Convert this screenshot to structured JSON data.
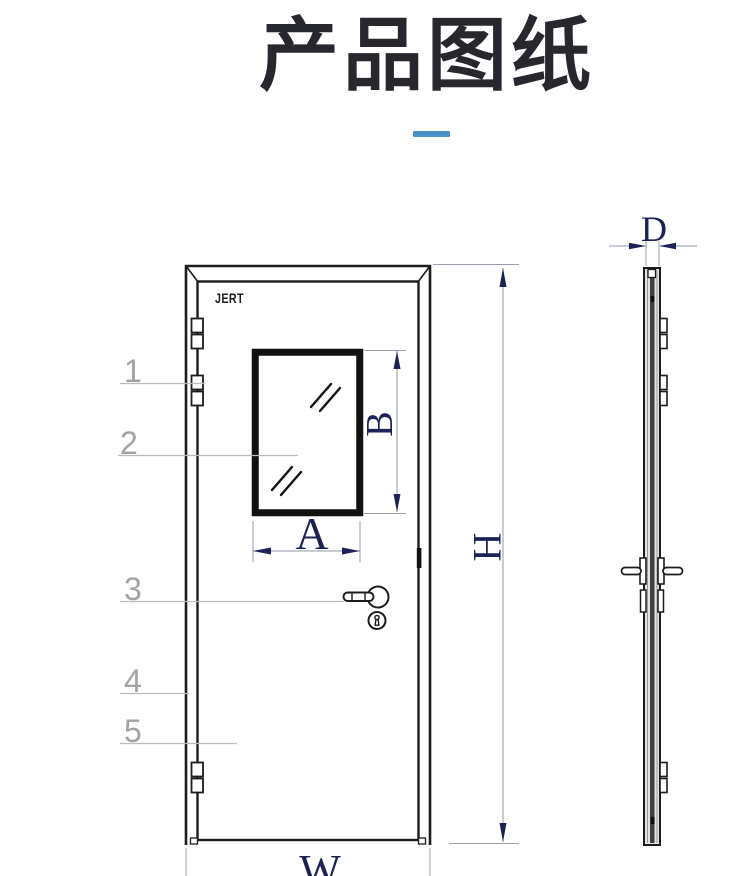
{
  "title": {
    "text": "产品图纸"
  },
  "front_view": {
    "brand": "JERT",
    "callouts": [
      "1",
      "2",
      "3",
      "4",
      "5"
    ],
    "dims": {
      "window_width": "A",
      "window_height": "B",
      "door_height": "H",
      "door_width": "W"
    }
  },
  "side_view": {
    "dims": {
      "thickness": "D"
    }
  },
  "colors": {
    "accent": "#4a90c9",
    "ink": "#1c1c1c",
    "dimension": "#1d2256",
    "muted": "#a3a3a3"
  }
}
